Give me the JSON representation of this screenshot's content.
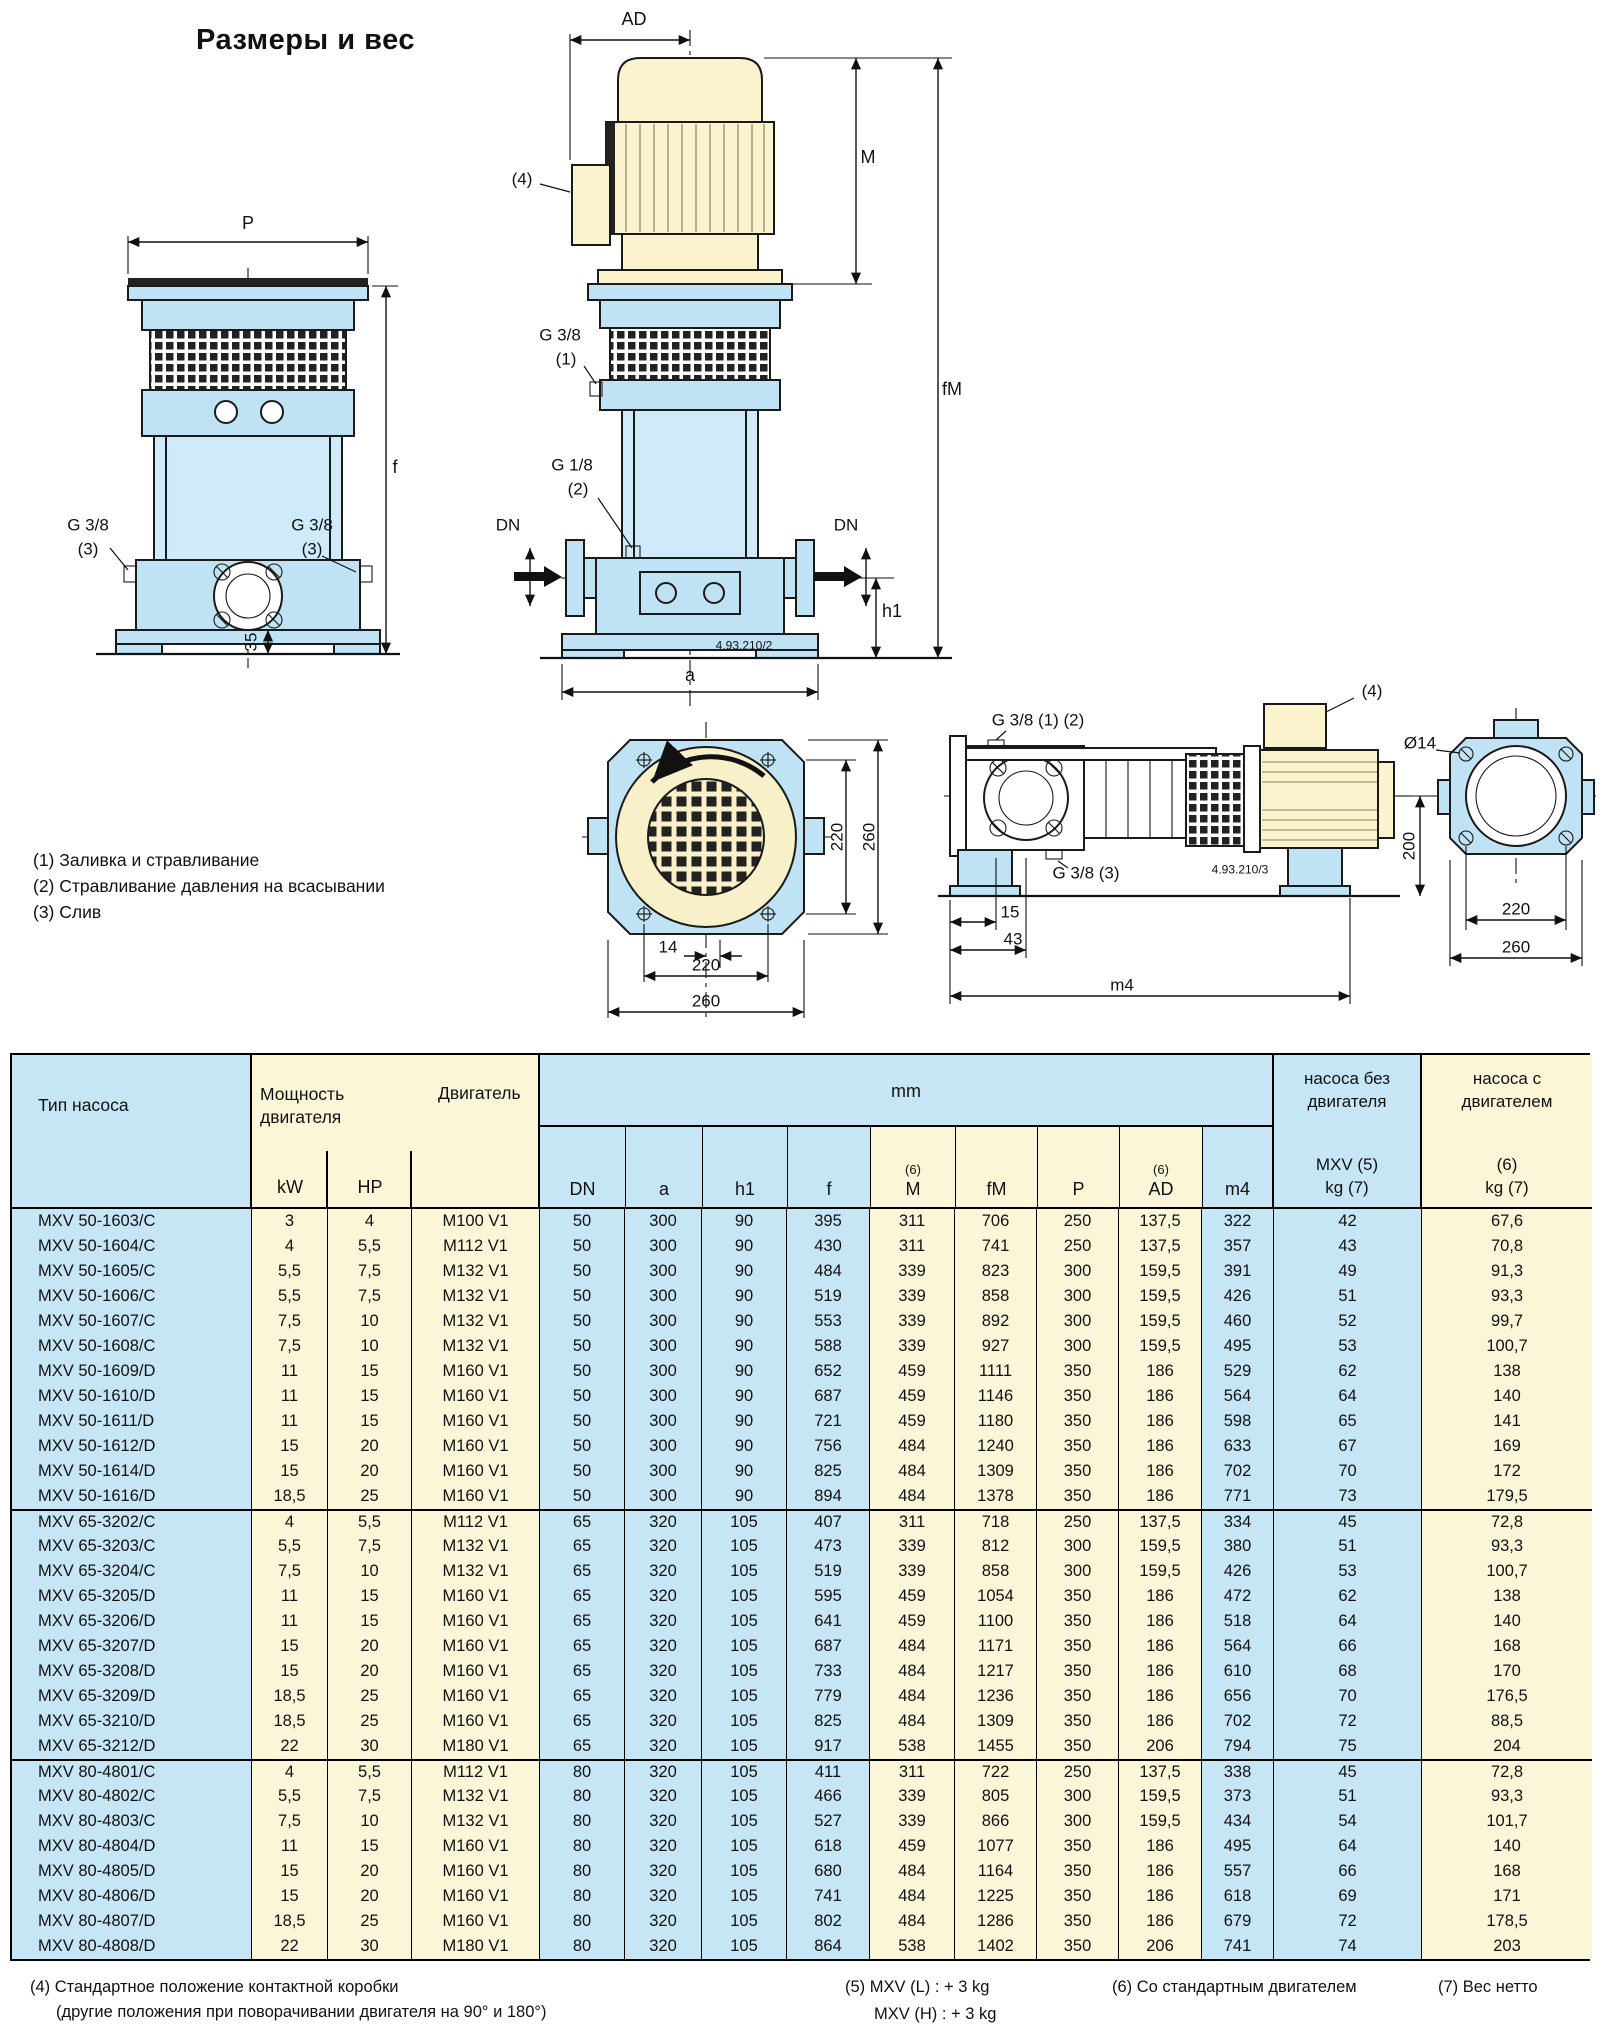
{
  "page": {
    "title": "Размеры и вес",
    "notes": [
      "(1) Заливка и стравливание",
      "(2) Стравливание давления на всасывании",
      "(3) Слив"
    ],
    "footnotes": {
      "note4_line1": "(4) Стандартное положение контактной коробки",
      "note4_line2": "(другие положения при поворачивании двигателя на 90° и 180°)",
      "note5_line1": "(5) MXV (L) : + 3 kg",
      "note5_line2": "MXV (H) : + 3 kg",
      "note6": "(6) Со стандартным двигателем",
      "note7": "(7) Вес нетто"
    }
  },
  "colors": {
    "pump_blue": "#bfe2f4",
    "barrel_blue": "#cfeaf8",
    "motor_cream": "#faf3cd",
    "table_blue": "#c6e6f6",
    "table_cream": "#fbf6d8"
  },
  "drawings": {
    "left_view": {
      "dim_p": "P",
      "dim_f": "f",
      "dim_35": "35",
      "g38": "G 3/8",
      "ref3": "(3)"
    },
    "front_view": {
      "dim_ad": "AD",
      "ref4": "(4)",
      "g38": "G 3/8",
      "ref1": "(1)",
      "g18": "G 1/8",
      "ref2": "(2)",
      "dn": "DN",
      "dim_m": "M",
      "dim_fm": "fM",
      "dim_h1": "h1",
      "dim_a": "a",
      "code": "4.93.210/2"
    },
    "bottom_view": {
      "dim_220_side": "220",
      "dim_260_side": "260",
      "dim_14": "14",
      "dim_220": "220",
      "dim_260": "260"
    },
    "side_view": {
      "g38_12": "G 3/8 (1) (2)",
      "ref4": "(4)",
      "g38_3": "G 3/8 (3)",
      "code": "4.93.210/3",
      "dim_15": "15",
      "dim_43": "43",
      "dim_m4": "m4",
      "dim_200": "200",
      "dia14": "Ø14",
      "dim_220": "220",
      "dim_260": "260"
    }
  },
  "table": {
    "header": {
      "pump_type": "Тип насоса",
      "power_line1": "Мощность",
      "power_line2": "двигателя",
      "motor": "Двигатель",
      "kw": "kW",
      "hp": "HP",
      "mm": "mm",
      "sub": [
        {
          "top": "",
          "label": "DN"
        },
        {
          "top": "",
          "label": "a"
        },
        {
          "top": "",
          "label": "h1"
        },
        {
          "top": "",
          "label": "f"
        },
        {
          "top": "(6)",
          "label": "M"
        },
        {
          "top": "",
          "label": "fM"
        },
        {
          "top": "",
          "label": "P"
        },
        {
          "top": "(6)",
          "label": "AD"
        },
        {
          "top": "",
          "label": "m4"
        }
      ],
      "weight_no_motor": {
        "line1": "насоса без",
        "line2": "двигателя",
        "line3": "MXV (5)",
        "line4": "kg (7)"
      },
      "weight_with_motor": {
        "line1": "насоса с",
        "line2": "двигателем",
        "line3": "(6)",
        "line4": "kg (7)"
      }
    },
    "groups": [
      {
        "name": "MXV 50",
        "rows": [
          [
            "MXV 50-1603/C",
            "3",
            "4",
            "M100 V1",
            "50",
            "300",
            "90",
            "395",
            "311",
            "706",
            "250",
            "137,5",
            "322",
            "42",
            "67,6"
          ],
          [
            "MXV 50-1604/C",
            "4",
            "5,5",
            "M112 V1",
            "50",
            "300",
            "90",
            "430",
            "311",
            "741",
            "250",
            "137,5",
            "357",
            "43",
            "70,8"
          ],
          [
            "MXV 50-1605/C",
            "5,5",
            "7,5",
            "M132 V1",
            "50",
            "300",
            "90",
            "484",
            "339",
            "823",
            "300",
            "159,5",
            "391",
            "49",
            "91,3"
          ],
          [
            "MXV 50-1606/C",
            "5,5",
            "7,5",
            "M132 V1",
            "50",
            "300",
            "90",
            "519",
            "339",
            "858",
            "300",
            "159,5",
            "426",
            "51",
            "93,3"
          ],
          [
            "MXV 50-1607/C",
            "7,5",
            "10",
            "M132 V1",
            "50",
            "300",
            "90",
            "553",
            "339",
            "892",
            "300",
            "159,5",
            "460",
            "52",
            "99,7"
          ],
          [
            "MXV 50-1608/C",
            "7,5",
            "10",
            "M132 V1",
            "50",
            "300",
            "90",
            "588",
            "339",
            "927",
            "300",
            "159,5",
            "495",
            "53",
            "100,7"
          ],
          [
            "MXV 50-1609/D",
            "11",
            "15",
            "M160 V1",
            "50",
            "300",
            "90",
            "652",
            "459",
            "1111",
            "350",
            "186",
            "529",
            "62",
            "138"
          ],
          [
            "MXV 50-1610/D",
            "11",
            "15",
            "M160 V1",
            "50",
            "300",
            "90",
            "687",
            "459",
            "1146",
            "350",
            "186",
            "564",
            "64",
            "140"
          ],
          [
            "MXV 50-1611/D",
            "11",
            "15",
            "M160 V1",
            "50",
            "300",
            "90",
            "721",
            "459",
            "1180",
            "350",
            "186",
            "598",
            "65",
            "141"
          ],
          [
            "MXV 50-1612/D",
            "15",
            "20",
            "M160 V1",
            "50",
            "300",
            "90",
            "756",
            "484",
            "1240",
            "350",
            "186",
            "633",
            "67",
            "169"
          ],
          [
            "MXV 50-1614/D",
            "15",
            "20",
            "M160 V1",
            "50",
            "300",
            "90",
            "825",
            "484",
            "1309",
            "350",
            "186",
            "702",
            "70",
            "172"
          ],
          [
            "MXV 50-1616/D",
            "18,5",
            "25",
            "M160 V1",
            "50",
            "300",
            "90",
            "894",
            "484",
            "1378",
            "350",
            "186",
            "771",
            "73",
            "179,5"
          ]
        ]
      },
      {
        "name": "MXV 65",
        "rows": [
          [
            "MXV 65-3202/C",
            "4",
            "5,5",
            "M112 V1",
            "65",
            "320",
            "105",
            "407",
            "311",
            "718",
            "250",
            "137,5",
            "334",
            "45",
            "72,8"
          ],
          [
            "MXV 65-3203/C",
            "5,5",
            "7,5",
            "M132 V1",
            "65",
            "320",
            "105",
            "473",
            "339",
            "812",
            "300",
            "159,5",
            "380",
            "51",
            "93,3"
          ],
          [
            "MXV 65-3204/C",
            "7,5",
            "10",
            "M132 V1",
            "65",
            "320",
            "105",
            "519",
            "339",
            "858",
            "300",
            "159,5",
            "426",
            "53",
            "100,7"
          ],
          [
            "MXV 65-3205/D",
            "11",
            "15",
            "M160 V1",
            "65",
            "320",
            "105",
            "595",
            "459",
            "1054",
            "350",
            "186",
            "472",
            "62",
            "138"
          ],
          [
            "MXV 65-3206/D",
            "11",
            "15",
            "M160 V1",
            "65",
            "320",
            "105",
            "641",
            "459",
            "1100",
            "350",
            "186",
            "518",
            "64",
            "140"
          ],
          [
            "MXV 65-3207/D",
            "15",
            "20",
            "M160 V1",
            "65",
            "320",
            "105",
            "687",
            "484",
            "1171",
            "350",
            "186",
            "564",
            "66",
            "168"
          ],
          [
            "MXV 65-3208/D",
            "15",
            "20",
            "M160 V1",
            "65",
            "320",
            "105",
            "733",
            "484",
            "1217",
            "350",
            "186",
            "610",
            "68",
            "170"
          ],
          [
            "MXV 65-3209/D",
            "18,5",
            "25",
            "M160 V1",
            "65",
            "320",
            "105",
            "779",
            "484",
            "1236",
            "350",
            "186",
            "656",
            "70",
            "176,5"
          ],
          [
            "MXV 65-3210/D",
            "18,5",
            "25",
            "M160 V1",
            "65",
            "320",
            "105",
            "825",
            "484",
            "1309",
            "350",
            "186",
            "702",
            "72",
            "88,5"
          ],
          [
            "MXV 65-3212/D",
            "22",
            "30",
            "M180 V1",
            "65",
            "320",
            "105",
            "917",
            "538",
            "1455",
            "350",
            "206",
            "794",
            "75",
            "204"
          ]
        ]
      },
      {
        "name": "MXV 80",
        "rows": [
          [
            "MXV 80-4801/C",
            "4",
            "5,5",
            "M112 V1",
            "80",
            "320",
            "105",
            "411",
            "311",
            "722",
            "250",
            "137,5",
            "338",
            "45",
            "72,8"
          ],
          [
            "MXV 80-4802/C",
            "5,5",
            "7,5",
            "M132 V1",
            "80",
            "320",
            "105",
            "466",
            "339",
            "805",
            "300",
            "159,5",
            "373",
            "51",
            "93,3"
          ],
          [
            "MXV 80-4803/C",
            "7,5",
            "10",
            "M132 V1",
            "80",
            "320",
            "105",
            "527",
            "339",
            "866",
            "300",
            "159,5",
            "434",
            "54",
            "101,7"
          ],
          [
            "MXV 80-4804/D",
            "11",
            "15",
            "M160 V1",
            "80",
            "320",
            "105",
            "618",
            "459",
            "1077",
            "350",
            "186",
            "495",
            "64",
            "140"
          ],
          [
            "MXV 80-4805/D",
            "15",
            "20",
            "M160 V1",
            "80",
            "320",
            "105",
            "680",
            "484",
            "1164",
            "350",
            "186",
            "557",
            "66",
            "168"
          ],
          [
            "MXV 80-4806/D",
            "15",
            "20",
            "M160 V1",
            "80",
            "320",
            "105",
            "741",
            "484",
            "1225",
            "350",
            "186",
            "618",
            "69",
            "171"
          ],
          [
            "MXV 80-4807/D",
            "18,5",
            "25",
            "M160 V1",
            "80",
            "320",
            "105",
            "802",
            "484",
            "1286",
            "350",
            "186",
            "679",
            "72",
            "178,5"
          ],
          [
            "MXV 80-4808/D",
            "22",
            "30",
            "M180 V1",
            "80",
            "320",
            "105",
            "864",
            "538",
            "1402",
            "350",
            "206",
            "741",
            "74",
            "203"
          ]
        ]
      }
    ]
  }
}
